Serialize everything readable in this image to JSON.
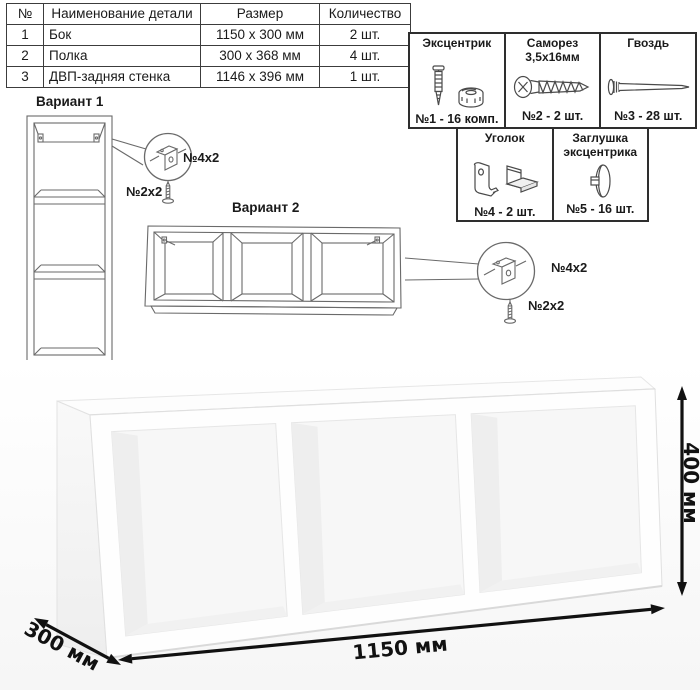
{
  "parts_table": {
    "headers": {
      "num": "№",
      "name": "Наименование детали",
      "size": "Размер",
      "qty": "Количество"
    },
    "rows": [
      {
        "num": "1",
        "name": "Бок",
        "size": "1150 x 300 мм",
        "qty": "2 шт."
      },
      {
        "num": "2",
        "name": "Полка",
        "size": "300 x 368 мм",
        "qty": "4 шт."
      },
      {
        "num": "3",
        "name": "ДВП-задняя стенка",
        "size": "1146 x 396 мм",
        "qty": "1 шт."
      }
    ]
  },
  "hardware": {
    "items": [
      {
        "title": "Эксцентрик",
        "label": "№1 - 16 комп.",
        "icon": "eccentric-cam-icon"
      },
      {
        "title": "Саморез 3,5х16мм",
        "label": "№2 - 2 шт.",
        "icon": "screw-icon"
      },
      {
        "title": "Гвоздь",
        "label": "№3 - 28 шт.",
        "icon": "nail-icon"
      },
      {
        "title": "Уголок",
        "label": "№4 - 2 шт.",
        "icon": "corner-bracket-icon"
      },
      {
        "title": "Заглушка эксцентрика",
        "label": "№5 - 16 шт.",
        "icon": "cam-cover-icon"
      }
    ]
  },
  "variants": {
    "v1": {
      "label": "Вариант 1",
      "bracket_label": "№4х2",
      "screw_label": "№2х2"
    },
    "v2": {
      "label": "Вариант 2",
      "bracket_label": "№4х2",
      "screw_label": "№2х2"
    }
  },
  "dimensions": {
    "width": "1150 мм",
    "height": "400 мм",
    "depth": "300 мм"
  }
}
